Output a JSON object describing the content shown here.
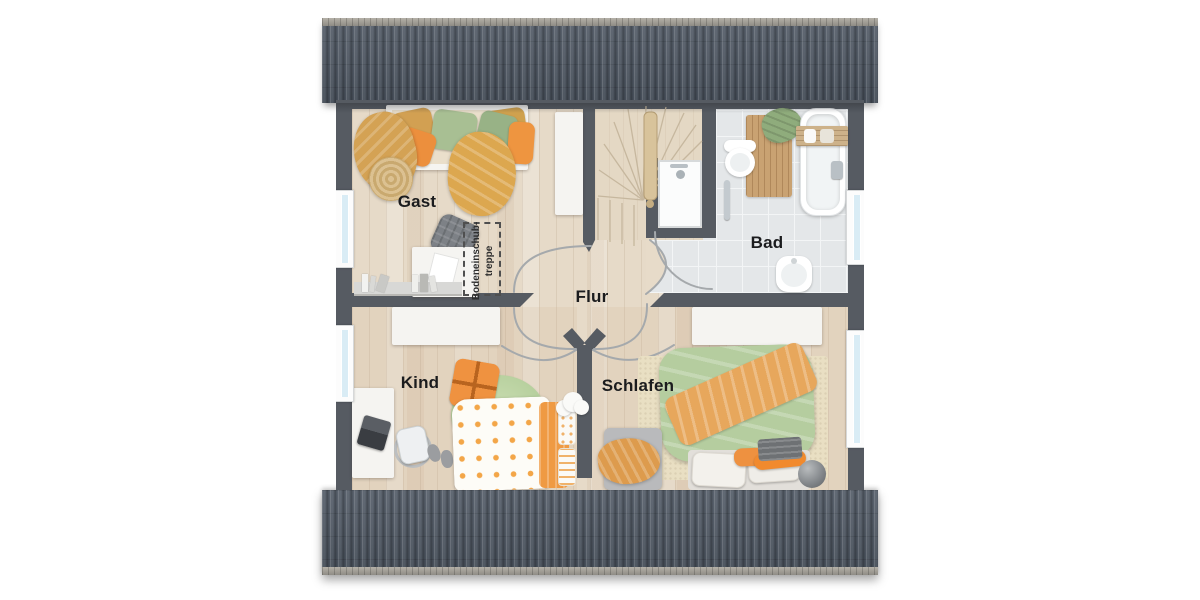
{
  "floor_plan": {
    "title_hint": "upper floor plan",
    "labels": {
      "guest_room": "Gast",
      "bathroom": "Bad",
      "hallway": "Flur",
      "child_room": "Kind",
      "bedroom": "Schlafen",
      "attic_hatch_line1": "Bodeneinschub-",
      "attic_hatch_line2": "treppe"
    },
    "colors": {
      "roof": "#4d5662",
      "roof_ridge": "#a6a29a",
      "wall": "#565b62",
      "floor_wood": "#e6dac8",
      "floor_tile": "#e4e7e9",
      "stair_wood": "#e4d8c4",
      "window_glass": "#d9ecf5",
      "accent_orange": "#ef9240",
      "accent_green": "#a8bf93",
      "accent_mustard": "#d2a052",
      "door_arc": "#a5a9ac"
    }
  }
}
